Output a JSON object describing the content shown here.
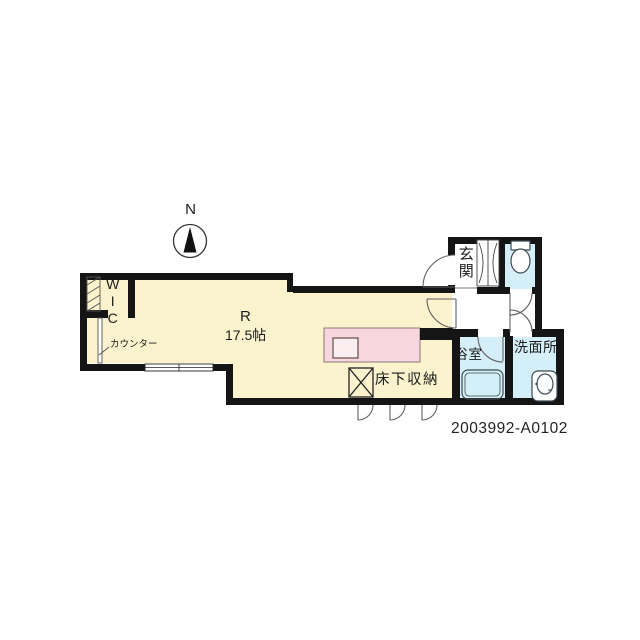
{
  "plan_id": "2003992-A0102",
  "compass": {
    "label": "N"
  },
  "rooms": {
    "main": {
      "label": "R",
      "area": "17.5帖"
    },
    "wic": {
      "label": "WIC"
    },
    "counter": {
      "label": "カウンター"
    },
    "entrance": {
      "label": "玄関"
    },
    "bathroom": {
      "label": "浴室"
    },
    "washroom": {
      "label": "洗面所"
    },
    "floor_storage": {
      "label": "床下収納"
    }
  },
  "colors": {
    "wall": "#151515",
    "room_fill": "#FAF3CD",
    "wet_area_fill": "#D5EFF8",
    "counter_fill": "#F8D6DF",
    "counter_sink_fill": "#FBEEF1",
    "line": "#606060",
    "fixture_stroke": "#3d4a52"
  }
}
